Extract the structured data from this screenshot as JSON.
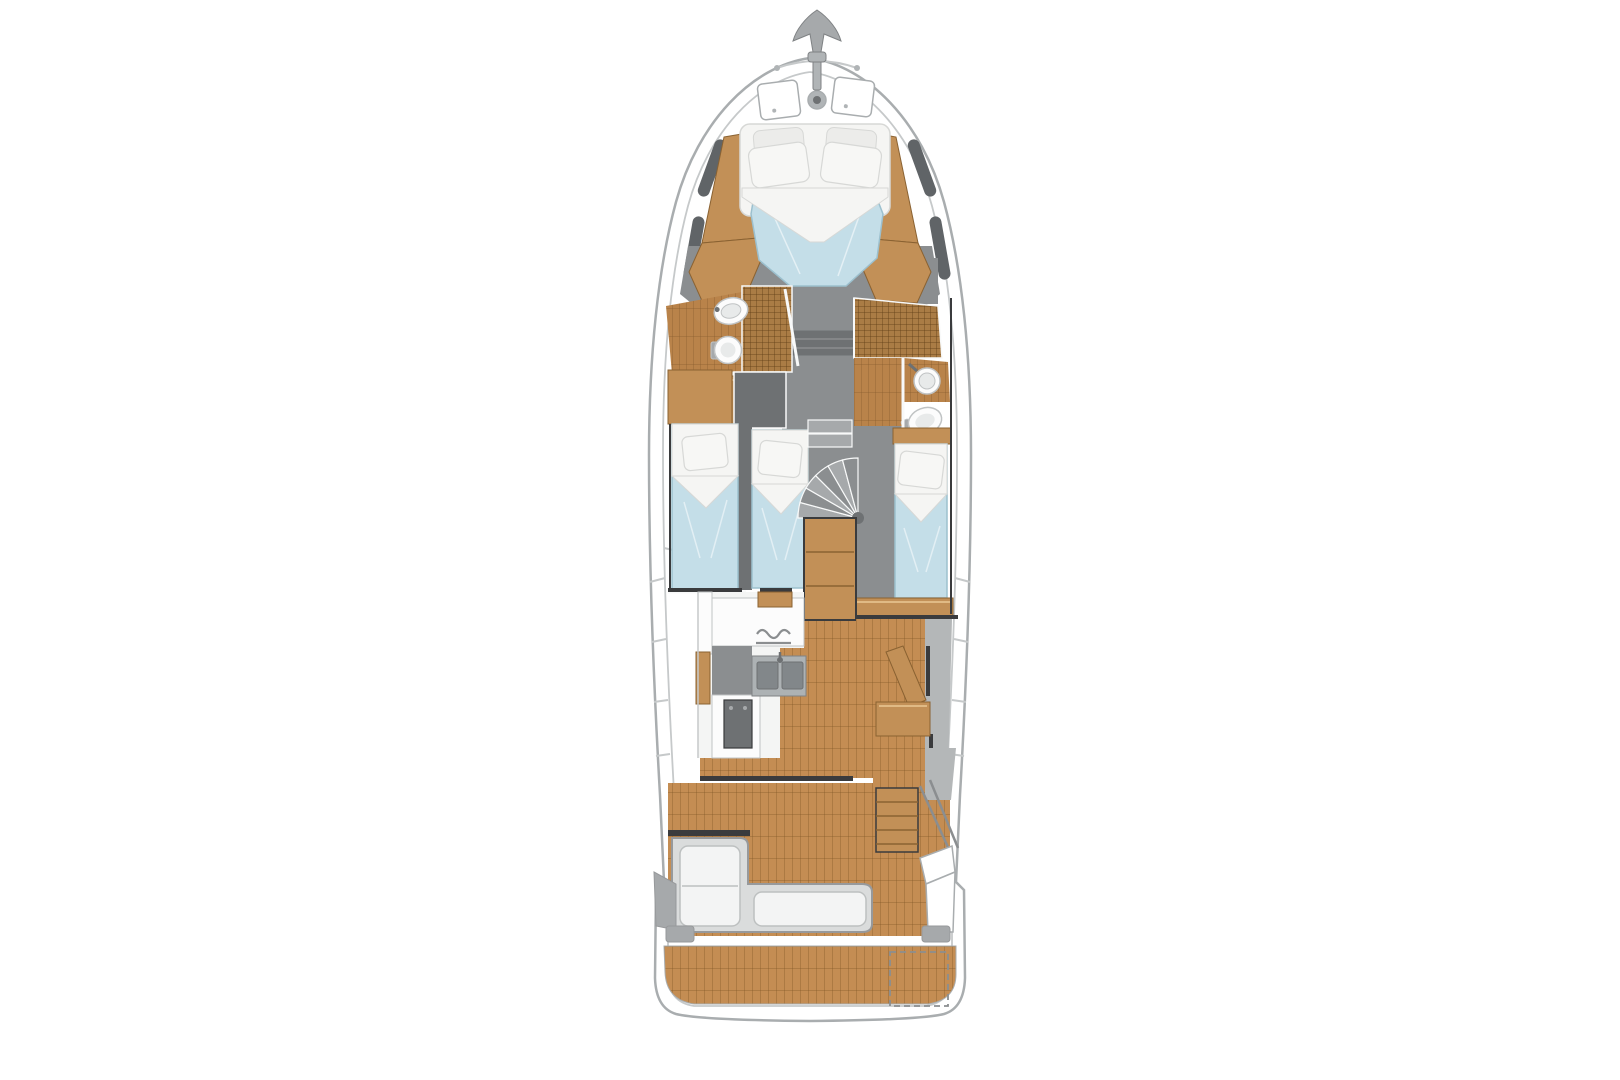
{
  "canvas": {
    "width": 1620,
    "height": 1080,
    "background": "#ffffff"
  },
  "palette": {
    "hullFill": "#ffffff",
    "hullLine": "#a9adaf",
    "innerLine": "#c6c9ca",
    "sideDeck": "#b4b7b8",
    "grayFloor": "#8b8e90",
    "grayMid": "#a6a9ab",
    "grayDark": "#6e7173",
    "charcoal": "#3a3b3d",
    "teak": "#c48d53",
    "teakLine": "#7d5526",
    "plank": "#b9834a",
    "plankLine": "#7f5728",
    "grate": "#aa7c45",
    "grateLine": "#5f3f16",
    "woodPanel": "#c29057",
    "woodEdge": "#8a6232",
    "woodHi": "#e0ba85",
    "bedBlue": "#c4dee8",
    "bedBlueEdge": "#9cc0ce",
    "linen": "#f5f5f3",
    "linenEdge": "#d7d8d6",
    "pillow": "#f7f7f5",
    "pillowBack": "#ececea",
    "fixture": "#fcfcfc",
    "fixtureEdge": "#c0c3c4",
    "fixtureInner": "#e8eaea",
    "steel": "#adb2b4",
    "steelDark": "#82878a",
    "metal": "#b0b4b6",
    "metalDark": "#7f8284",
    "benchShell": "#dadcdc",
    "benchEdge": "#97999b",
    "cushion": "#f3f4f4",
    "cushionEdge": "#bdc0c0",
    "whiteArea": "#f4f5f4",
    "white": "#f8f9f9",
    "windowDark": "#606467"
  },
  "features": {
    "view": "overhead yacht deck plan",
    "anchor_at_bow": true,
    "foredeck_hatches": 2,
    "double_v_berth": 1,
    "single_berths": 3,
    "heads": 2,
    "toilets": 2,
    "bathroom_sinks": 2,
    "galley_sink_basins": 2,
    "spiral_staircase": true,
    "cockpit_bench": "L-shaped",
    "flybridge_stairs": true,
    "swim_platform": true
  },
  "regions": [
    "bow-anchor",
    "foredeck",
    "owner-cabin-v-berth",
    "port-head",
    "starboard-head",
    "twin-cabin",
    "starboard-cabin",
    "spiral-staircase",
    "galley",
    "salon",
    "side-decks",
    "cockpit",
    "flybridge-stairs",
    "stern-bench",
    "swim-platform"
  ]
}
